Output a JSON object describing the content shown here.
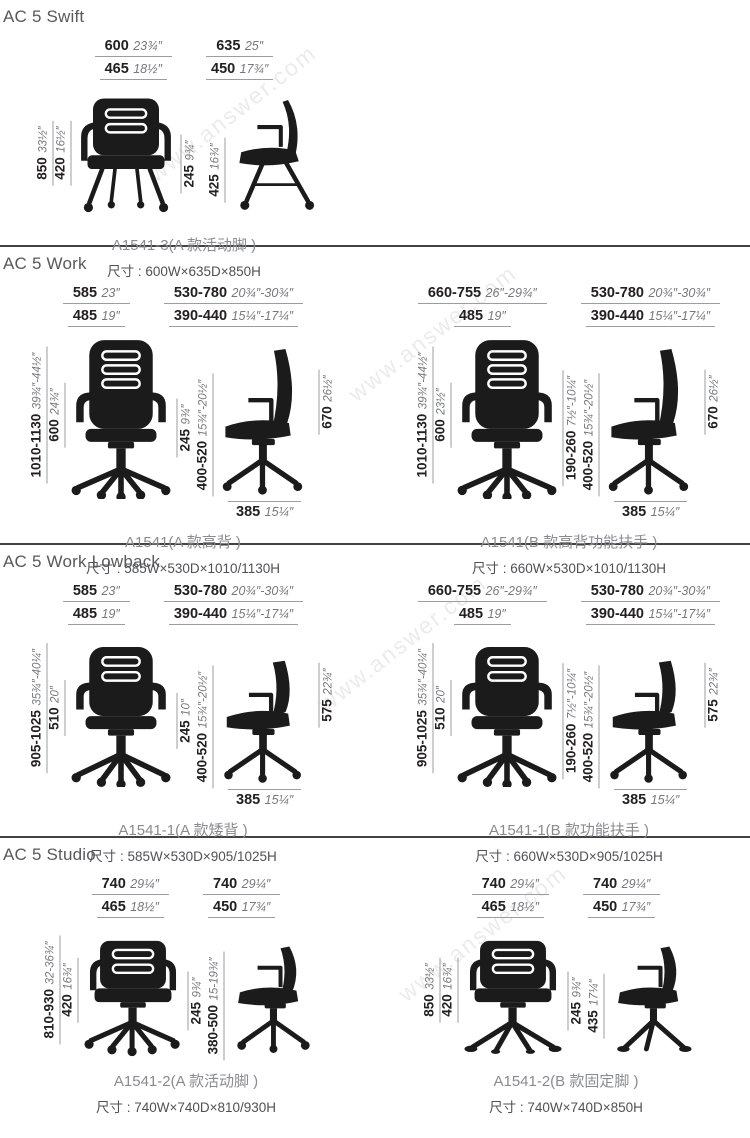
{
  "page": {
    "watermark": "www.answer.com"
  },
  "sections": [
    {
      "title": "AC 5 Swift",
      "figs": [
        {
          "cap": "A1541-3(A 款活动脚 )",
          "size": "尺寸 : 600W×635D×850H",
          "top_front": [
            {
              "mm": "600",
              "in": "23¾″"
            },
            {
              "mm": "465",
              "in": "18½″"
            }
          ],
          "top_side": [
            {
              "mm": "635",
              "in": "25″"
            },
            {
              "mm": "450",
              "in": "17¾″"
            }
          ],
          "left": [
            {
              "mm": "850",
              "in": "33½″"
            },
            {
              "mm": "420",
              "in": "16½″"
            }
          ],
          "mid": [
            {
              "mm": "245",
              "in": "9¾″"
            }
          ],
          "side_left": [
            {
              "mm": "425",
              "in": "16¾″"
            }
          ]
        }
      ]
    },
    {
      "title": "AC 5 Work",
      "figs": [
        {
          "cap": "A1541(A 款高背 )",
          "size": "尺寸 : 585W×530D×1010/1130H",
          "top_front": [
            {
              "mm": "585",
              "in": "23″"
            },
            {
              "mm": "485",
              "in": "19″"
            }
          ],
          "top_side": [
            {
              "mm": "530-780",
              "in": "20¾″-30¾″"
            },
            {
              "mm": "390-440",
              "in": "15¼″-17¼″"
            }
          ],
          "left": [
            {
              "mm": "1010-1130",
              "in": "39¾″-44½″"
            },
            {
              "mm": "600",
              "in": "24¾″"
            }
          ],
          "mid": [
            {
              "mm": "245",
              "in": "9¾″"
            }
          ],
          "side_left": [
            {
              "mm": "400-520",
              "in": "15¾″-20½″"
            }
          ],
          "right": [
            {
              "mm": "670",
              "in": "26½″"
            }
          ],
          "bottom": {
            "mm": "385",
            "in": "15¼″"
          }
        },
        {
          "cap": "A1541(B 款高背功能扶手 )",
          "size": "尺寸 : 660W×530D×1010/1130H",
          "top_front": [
            {
              "mm": "660-755",
              "in": "26″-29¾″"
            },
            {
              "mm": "485",
              "in": "19″"
            }
          ],
          "top_side": [
            {
              "mm": "530-780",
              "in": "20¾″-30¾″"
            },
            {
              "mm": "390-440",
              "in": "15¼″-17¼″"
            }
          ],
          "left": [
            {
              "mm": "1010-1130",
              "in": "39¾″-44½″"
            },
            {
              "mm": "600",
              "in": "23½″"
            }
          ],
          "mid": [
            {
              "mm": "190-260",
              "in": "7½″-10¼″"
            }
          ],
          "side_left": [
            {
              "mm": "400-520",
              "in": "15¾″-20½″"
            }
          ],
          "right": [
            {
              "mm": "670",
              "in": "26½″"
            }
          ],
          "bottom": {
            "mm": "385",
            "in": "15¼″"
          }
        }
      ]
    },
    {
      "title": "AC 5 Work Lowback",
      "figs": [
        {
          "cap": "A1541-1(A 款矮背 )",
          "size": "尺寸 : 585W×530D×905/1025H",
          "top_front": [
            {
              "mm": "585",
              "in": "23″"
            },
            {
              "mm": "485",
              "in": "19″"
            }
          ],
          "top_side": [
            {
              "mm": "530-780",
              "in": "20¾″-30¾″"
            },
            {
              "mm": "390-440",
              "in": "15¼″-17¼″"
            }
          ],
          "left": [
            {
              "mm": "905-1025",
              "in": "35¾″-40¼″"
            },
            {
              "mm": "510",
              "in": "20″"
            }
          ],
          "mid": [
            {
              "mm": "245",
              "in": "10″"
            }
          ],
          "side_left": [
            {
              "mm": "400-520",
              "in": "15¾″-20½″"
            }
          ],
          "right": [
            {
              "mm": "575",
              "in": "22¾″"
            }
          ],
          "bottom": {
            "mm": "385",
            "in": "15¼″"
          }
        },
        {
          "cap": "A1541-1(B 款功能扶手 )",
          "size": "尺寸 : 660W×530D×905/1025H",
          "top_front": [
            {
              "mm": "660-755",
              "in": "26″-29¾″"
            },
            {
              "mm": "485",
              "in": "19″"
            }
          ],
          "top_side": [
            {
              "mm": "530-780",
              "in": "20¾″-30¾″"
            },
            {
              "mm": "390-440",
              "in": "15¼″-17¼″"
            }
          ],
          "left": [
            {
              "mm": "905-1025",
              "in": "35¾″-40¼″"
            },
            {
              "mm": "510",
              "in": "20″"
            }
          ],
          "mid": [
            {
              "mm": "190-260",
              "in": "7½″-10¼″"
            }
          ],
          "side_left": [
            {
              "mm": "400-520",
              "in": "15¾″-20½″"
            }
          ],
          "right": [
            {
              "mm": "575",
              "in": "22¾″"
            }
          ],
          "bottom": {
            "mm": "385",
            "in": "15¼″"
          }
        }
      ]
    },
    {
      "title": "AC 5 Studio",
      "figs": [
        {
          "cap": "A1541-2(A 款活动脚 )",
          "size": "尺寸 : 740W×740D×810/930H",
          "top_front": [
            {
              "mm": "740",
              "in": "29¼″"
            },
            {
              "mm": "465",
              "in": "18½″"
            }
          ],
          "top_side": [
            {
              "mm": "740",
              "in": "29¼″"
            },
            {
              "mm": "450",
              "in": "17¾″"
            }
          ],
          "left": [
            {
              "mm": "810-930",
              "in": "32-36¾″"
            },
            {
              "mm": "420",
              "in": "16¾″"
            }
          ],
          "mid": [
            {
              "mm": "245",
              "in": "9¾″"
            }
          ],
          "side_left": [
            {
              "mm": "380-500",
              "in": "15-19¾″"
            }
          ]
        },
        {
          "cap": "A1541-2(B 款固定脚 )",
          "size": "尺寸 : 740W×740D×850H",
          "top_front": [
            {
              "mm": "740",
              "in": "29¼″"
            },
            {
              "mm": "465",
              "in": "18½″"
            }
          ],
          "top_side": [
            {
              "mm": "740",
              "in": "29¼″"
            },
            {
              "mm": "450",
              "in": "17¾″"
            }
          ],
          "left": [
            {
              "mm": "850",
              "in": "33½″"
            },
            {
              "mm": "420",
              "in": "16¾″"
            }
          ],
          "mid": [
            {
              "mm": "245",
              "in": "9¾″"
            }
          ],
          "side_left": [
            {
              "mm": "435",
              "in": "17¼″"
            }
          ]
        }
      ]
    }
  ]
}
